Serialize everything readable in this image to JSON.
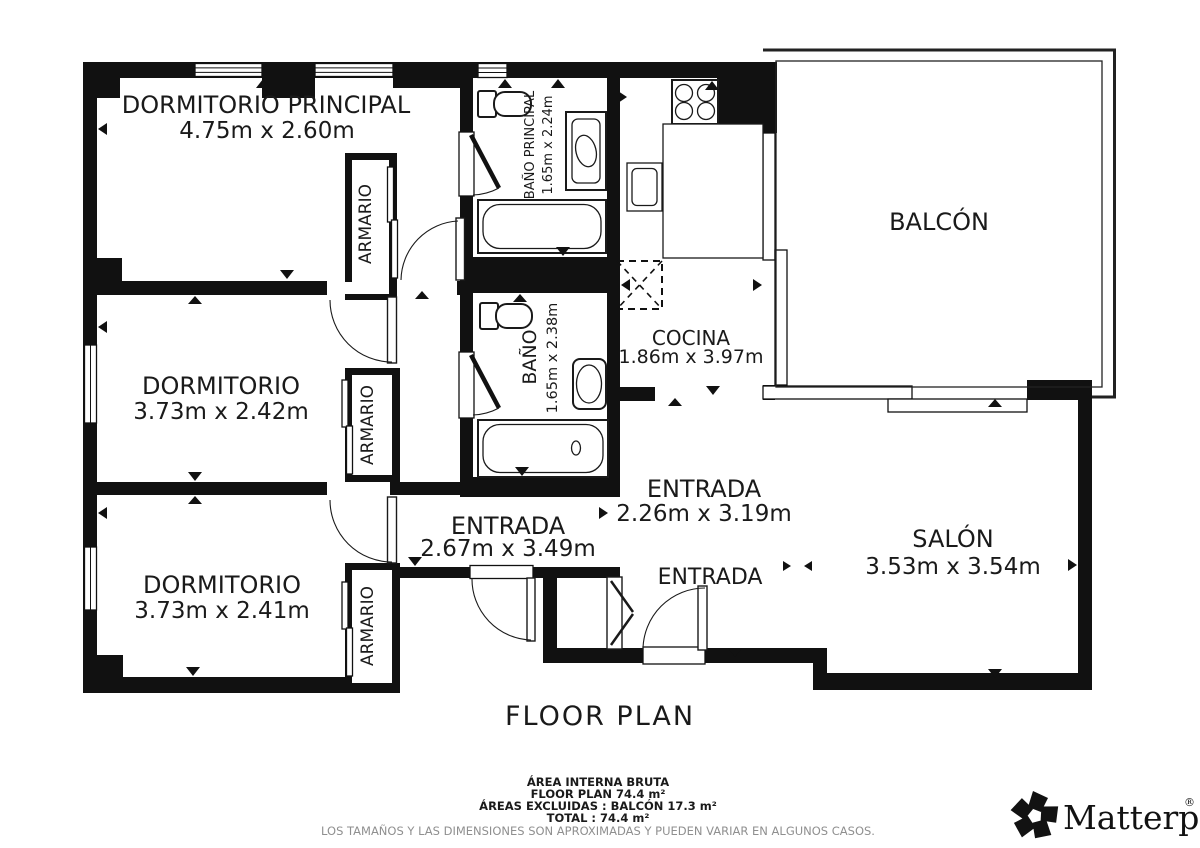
{
  "plan": {
    "rooms": {
      "dormitorio_principal": {
        "name": "DORMITORIO PRINCIPAL",
        "dims": "4.75m x 2.60m"
      },
      "dormitorio_2": {
        "name": "DORMITORIO",
        "dims": "3.73m x 2.42m"
      },
      "dormitorio_3": {
        "name": "DORMITORIO",
        "dims": "3.73m x 2.41m"
      },
      "bano_principal": {
        "name": "BAÑO PRINCIPAL",
        "dims": "1.65m x 2.24m"
      },
      "bano": {
        "name": "BAÑO",
        "dims": "1.65m x 2.38m"
      },
      "cocina": {
        "name": "COCINA",
        "dims": "1.86m x 3.97m"
      },
      "entrada_hall": {
        "name": "ENTRADA",
        "dims": "2.67m x 3.49m"
      },
      "entrada_main": {
        "name": "ENTRADA",
        "dims": "2.26m x 3.19m"
      },
      "entrada_door": {
        "name": "ENTRADA"
      },
      "salon": {
        "name": "SALÓN",
        "dims": "3.53m x 3.54m"
      },
      "balcon": {
        "name": "BALCÓN"
      },
      "armario": {
        "name": "ARMARIO"
      }
    }
  },
  "footer": {
    "title": "FLOOR PLAN",
    "area_lines": [
      "ÁREA INTERNA BRUTA",
      "FLOOR PLAN 74.4 m²",
      "ÁREAS EXCLUIDAS :  BALCÓN 17.3 m²",
      "TOTAL :  74.4 m²"
    ],
    "disclaimer": "LOS TAMAÑOS Y LAS DIMENSIONES SON APROXIMADAS Y PUEDEN VARIAR EN ALGUNOS CASOS."
  },
  "branding": {
    "wordmark": "Matterport",
    "registered": "®"
  }
}
